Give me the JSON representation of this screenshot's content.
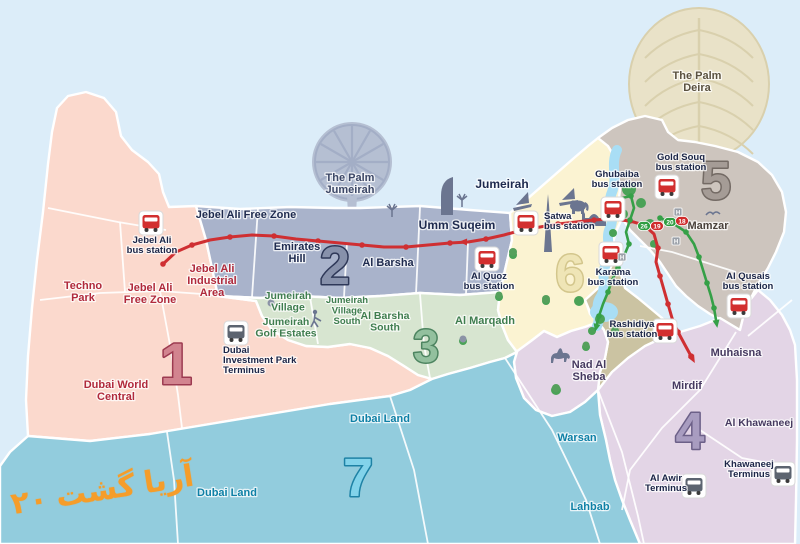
{
  "title": "Dubai bus zones map",
  "colors": {
    "sea": "#dcedf9",
    "creek": "#a9def5",
    "park": "#4aa257",
    "route_red": "#cf2f32",
    "route_green": "#35a047",
    "station_red": "#d22f2f",
    "station_gray": "#5c6470",
    "label_navy": "#1b2547",
    "hmarker": "#9aa0a8"
  },
  "watermark": {
    "part1": "۲۰",
    "part2": "گشت",
    "part3": "آریا"
  },
  "map": {
    "zones": [
      {
        "id": "1",
        "fill": "#fbd9cd",
        "poly": "57,108 68,96 86,92 104,98 116,112 121,136 132,150 148,162 159,174 163,192 169,207 196,206 206,240 212,268 218,296 256,301 262,316 272,330 288,340 306,346 328,347 350,344 370,348 388,356 404,366 418,375 432,379 410,390 390,396 330,404 270,414 210,424 150,434 90,441 28,436 26,400 28,356 32,308 37,260 43,212 48,164 52,132",
        "num": {
          "text": "1",
          "x": 176,
          "y": 384,
          "size": 58,
          "fill": "#d2848f",
          "stroke": "#9c3a50"
        }
      },
      {
        "id": "2",
        "fill": "#a9b3cb",
        "poly": "196,206 240,209 290,207 335,208 360,208 420,206 470,210 510,213 512,240 505,270 500,292 460,295 420,293 380,296 340,298 300,296 260,298 218,296 212,268 206,240",
        "num": {
          "text": "2",
          "x": 335,
          "y": 284,
          "size": 54,
          "fill": "#8791ab",
          "stroke": "#2e3858"
        }
      },
      {
        "id": "3",
        "fill": "#d7e5d0",
        "poly": "218,296 260,298 300,296 340,298 380,296 420,293 460,295 500,292 498,310 502,325 508,340 517,352 505,358 490,362 470,368 448,374 432,379 418,375 404,366 388,356 370,348 350,344 328,347 306,346 288,340 272,330 262,316 256,301",
        "num": {
          "text": "3",
          "x": 426,
          "y": 362,
          "size": 46,
          "fill": "#93c09e",
          "stroke": "#4d8460"
        }
      },
      {
        "id": "6",
        "fill": "#fbf3d2",
        "poly": "510,213 526,200 542,186 558,172 574,158 588,146 598,138 608,146 614,156 618,172 620,190 618,206 622,218 616,232 612,246 616,258 608,272 605,284 596,292 586,302 590,314 598,322 585,327 571,331 557,337 544,331 531,341 517,352 508,340 502,325 498,310 500,292 505,270 512,240",
        "num": {
          "text": "6",
          "x": 570,
          "y": 291,
          "size": 52,
          "fill": "#efe5b6",
          "stroke": "#d3c68c"
        }
      },
      {
        "id": "5",
        "fill": "#cdc5be",
        "poly": "598,138 612,128 628,120 645,116 662,120 668,132 678,140 695,142 715,146 738,152 758,162 772,175 782,192 786,212 784,232 776,252 768,268 758,284 750,300 744,314 740,330 725,322 710,314 698,306 686,296 676,286 668,274 660,262 650,250 640,240 630,230 622,218 618,206 620,190 618,172 614,156 608,146",
        "num": {
          "text": "5",
          "x": 716,
          "y": 199,
          "size": 54,
          "fill": "#a59c96",
          "stroke": "#736a64"
        }
      },
      {
        "id": "khaki",
        "fill": "#cbc3a2",
        "poly": "585,300 596,290 605,282 608,272 616,258 625,288 638,298 650,308 662,318 672,330 680,342 684,355 676,368 662,378 646,386 630,390 614,392 598,390 600,372 605,358 608,342 604,330 598,322 590,312"
      },
      {
        "id": "nad",
        "fill": "#e3d5e6",
        "poly": "516,352 531,341 544,331 557,337 571,331 585,327 598,322 604,330 608,342 605,358 600,372 598,390 585,402 570,412 552,416 536,410 524,398 516,378 514,362"
      },
      {
        "id": "4",
        "fill": "#e3d5e6",
        "poly": "598,390 612,372 628,358 645,346 662,338 680,332 700,326 720,318 740,330 744,314 750,300 758,290 770,300 782,315 790,330 795,345 797,380 797,440 796,500 795,544 640,544 630,520 622,500 615,480 610,460 606,440 600,415",
        "num": {
          "text": "4",
          "x": 690,
          "y": 449,
          "size": 52,
          "fill": "#a89cc0",
          "stroke": "#6c6088"
        }
      },
      {
        "id": "7",
        "fill": "#92ccdd",
        "poly": "28,436 90,441 150,434 210,424 270,414 330,404 390,396 410,390 432,379 448,374 470,368 490,362 505,358 517,352 514,362 516,378 524,398 536,410 552,416 570,412 585,402 598,390 600,415 606,440 610,460 615,480 622,500 630,520 640,544 0,544 0,466 10,452",
        "num": {
          "text": "7",
          "x": 358,
          "y": 496,
          "size": 54,
          "fill": "#82d3ea",
          "stroke": "#1e82a5"
        }
      }
    ],
    "palm_jumeirah": {
      "cx": 352,
      "cy": 162,
      "r": 40,
      "fill": "#b5bfd2",
      "frond": "#a3aec6"
    },
    "palm_deira": {
      "cx": 699,
      "cy": 84,
      "rx": 70,
      "ry": 76,
      "fill": "#e9e2c8",
      "frond": "#d9d0ad"
    },
    "creek": {
      "d": "M 617,150 C 610,165 618,178 612,192 C 606,206 616,216 610,228 C 604,240 614,252 606,264 C 600,276 608,286 600,298 C 594,308 602,316 597,326",
      "blob": {
        "cx": 604,
        "cy": 312,
        "rx": 14,
        "ry": 10
      }
    },
    "parks": [
      [
        629,
        189,
        7
      ],
      [
        641,
        203,
        5
      ],
      [
        623,
        214,
        5
      ],
      [
        650,
        224,
        5
      ],
      [
        613,
        233,
        4
      ],
      [
        654,
        244,
        4
      ],
      [
        600,
        319,
        5
      ],
      [
        592,
        331,
        4
      ],
      [
        579,
        301,
        5
      ],
      [
        586,
        347,
        4
      ],
      [
        615,
        331,
        4
      ],
      [
        513,
        255,
        4
      ],
      [
        556,
        390,
        5
      ],
      [
        463,
        341,
        4
      ],
      [
        546,
        301,
        4
      ],
      [
        499,
        297,
        4
      ]
    ],
    "roads": [
      "48,208 118,222 166,230",
      "40,300 100,293 160,291 216,295",
      "120,222 125,292",
      "160,291 170,345 178,395 182,428",
      "258,208 252,297",
      "347,243 344,297",
      "420,207 416,294",
      "468,242 466,294",
      "310,297 318,344",
      "420,294 424,345 430,378",
      "736,332 700,390 662,428 630,470 622,510",
      "792,300 748,336",
      "700,430 742,458 794,468",
      "598,390 622,452 638,516 644,544",
      "505,358 552,430 586,500 600,544",
      "390,396 414,470 428,544",
      "167,432 174,480 178,544",
      "640,246 672,252 704,262 736,272"
    ],
    "routes": [
      {
        "id": "red-main",
        "color": "#cf2f32",
        "width": 3,
        "dots": true,
        "arrow": false,
        "points": [
          [
            163,
            264
          ],
          [
            176,
            252
          ],
          [
            192,
            245
          ],
          [
            210,
            240
          ],
          [
            230,
            237
          ],
          [
            252,
            235
          ],
          [
            274,
            236
          ],
          [
            296,
            239
          ],
          [
            318,
            241
          ],
          [
            340,
            243
          ],
          [
            362,
            245
          ],
          [
            384,
            247
          ],
          [
            406,
            247
          ],
          [
            428,
            245
          ],
          [
            450,
            243
          ],
          [
            468,
            242
          ],
          [
            486,
            239
          ],
          [
            504,
            235
          ],
          [
            522,
            230
          ],
          [
            540,
            227
          ],
          [
            558,
            224
          ],
          [
            576,
            222
          ],
          [
            594,
            220
          ],
          [
            612,
            219
          ],
          [
            630,
            221
          ],
          [
            644,
            225
          ]
        ]
      },
      {
        "id": "red-south",
        "color": "#cf2f32",
        "width": 3,
        "dots": true,
        "arrow": true,
        "points": [
          [
            644,
            225
          ],
          [
            654,
            234
          ],
          [
            658,
            248
          ],
          [
            656,
            262
          ],
          [
            660,
            276
          ],
          [
            664,
            290
          ],
          [
            668,
            304
          ],
          [
            672,
            318
          ],
          [
            678,
            332
          ],
          [
            685,
            345
          ],
          [
            691,
            356
          ]
        ]
      },
      {
        "id": "green-west",
        "color": "#35a047",
        "width": 2.6,
        "dots": true,
        "arrow": true,
        "points": [
          [
            613,
            205
          ],
          [
            622,
            198
          ],
          [
            631,
            196
          ],
          [
            634,
            208
          ],
          [
            630,
            220
          ],
          [
            626,
            232
          ],
          [
            629,
            244
          ],
          [
            624,
            256
          ],
          [
            618,
            268
          ],
          [
            612,
            280
          ],
          [
            608,
            292
          ],
          [
            603,
            304
          ],
          [
            599,
            316
          ],
          [
            597,
            324
          ]
        ]
      },
      {
        "id": "green-east",
        "color": "#35a047",
        "width": 2.6,
        "dots": true,
        "arrow": true,
        "points": [
          [
            660,
            218
          ],
          [
            674,
            224
          ],
          [
            686,
            232
          ],
          [
            694,
            244
          ],
          [
            699,
            257
          ],
          [
            703,
            270
          ],
          [
            707,
            283
          ],
          [
            711,
            296
          ],
          [
            714,
            308
          ],
          [
            716,
            320
          ]
        ]
      }
    ],
    "route_markers": [
      {
        "x": 467,
        "y": 242,
        "angle": 182,
        "color": "#cf2f32"
      }
    ],
    "badges": [
      {
        "text": "26",
        "fill": "#2f9e41",
        "x": 644,
        "y": 226
      },
      {
        "text": "19",
        "fill": "#cf2b2b",
        "x": 657,
        "y": 226
      },
      {
        "text": "20",
        "fill": "#2f9e41",
        "x": 670,
        "y": 222
      },
      {
        "text": "18",
        "fill": "#cf2b2b",
        "x": 682,
        "y": 221
      }
    ],
    "h_markers": [
      {
        "x": 678,
        "y": 212,
        "text": "H"
      },
      {
        "x": 676,
        "y": 241,
        "text": "H"
      },
      {
        "x": 622,
        "y": 257,
        "text": "H"
      }
    ],
    "stations": [
      {
        "id": "jebel-ali-bus-station",
        "type": "red",
        "x": 151,
        "y": 223,
        "lines": [
          "Jebel Ali",
          "bus station"
        ],
        "lx": 152,
        "ly": 243,
        "anchor": "middle"
      },
      {
        "id": "dubai-investment-park-terminus",
        "type": "gray",
        "x": 236,
        "y": 333,
        "lines": [
          "Dubai",
          "Investment Park",
          "Terminus"
        ],
        "lx": 223,
        "ly": 353,
        "anchor": "start"
      },
      {
        "id": "al-quoz-bus-station",
        "type": "red",
        "x": 487,
        "y": 259,
        "lines": [
          "Al Quoz",
          "bus station"
        ],
        "lx": 489,
        "ly": 279,
        "anchor": "middle"
      },
      {
        "id": "satwa-bus-station",
        "type": "red",
        "x": 526,
        "y": 223,
        "lines": [
          "Satwa",
          "bus station"
        ],
        "lx": 544,
        "ly": 219,
        "anchor": "start"
      },
      {
        "id": "ghubaiba-bus-station",
        "type": "red",
        "x": 613,
        "y": 209,
        "lines": [
          "Ghubaiba",
          "bus station"
        ],
        "lx": 617,
        "ly": 177,
        "anchor": "middle"
      },
      {
        "id": "gold-souq-bus-station",
        "type": "red",
        "x": 667,
        "y": 187,
        "lines": [
          "Gold Souq",
          "bus station"
        ],
        "lx": 681,
        "ly": 160,
        "anchor": "middle"
      },
      {
        "id": "karama-bus-station",
        "type": "red",
        "x": 611,
        "y": 254,
        "lines": [
          "Karama",
          "bus station"
        ],
        "lx": 613,
        "ly": 275,
        "anchor": "middle"
      },
      {
        "id": "rashidiya-bus-station",
        "type": "red",
        "x": 665,
        "y": 331,
        "lines": [
          "Rashidiya",
          "bus station"
        ],
        "lx": 632,
        "ly": 327,
        "anchor": "middle"
      },
      {
        "id": "al-qusais-bus-station",
        "type": "red",
        "x": 739,
        "y": 306,
        "lines": [
          "Al Qusais",
          "bus station"
        ],
        "lx": 748,
        "ly": 279,
        "anchor": "middle"
      },
      {
        "id": "khawaneej-terminus",
        "type": "gray",
        "x": 783,
        "y": 474,
        "lines": [
          "Khawaneej",
          "Terminus"
        ],
        "lx": 749,
        "ly": 467,
        "anchor": "middle"
      },
      {
        "id": "al-awir-terminus",
        "type": "gray",
        "x": 694,
        "y": 486,
        "lines": [
          "Al Awir",
          "Terminus"
        ],
        "lx": 666,
        "ly": 481,
        "anchor": "middle"
      }
    ],
    "labels": [
      {
        "text": "Techno\nPark",
        "x": 83,
        "y": 289,
        "size": 11,
        "color": "#b02a3c"
      },
      {
        "text": "Jebel Ali\nFree Zone",
        "x": 150,
        "y": 291,
        "size": 11,
        "color": "#b02a3c"
      },
      {
        "text": "Jebel Ali\nIndustrial\nArea",
        "x": 212,
        "y": 272,
        "size": 11,
        "color": "#b02a3c"
      },
      {
        "text": "Dubai World\nCentral",
        "x": 116,
        "y": 388,
        "size": 11,
        "color": "#b02a3c"
      },
      {
        "text": "Jebel Ali Free Zone",
        "x": 246,
        "y": 218,
        "size": 11,
        "color": "#1e2a4e"
      },
      {
        "text": "Emirates\nHill",
        "x": 297,
        "y": 250,
        "size": 11,
        "color": "#1e2a4e"
      },
      {
        "text": "Al Barsha",
        "x": 388,
        "y": 266,
        "size": 11,
        "color": "#1e2a4e"
      },
      {
        "text": "Umm Suqeim",
        "x": 457,
        "y": 229,
        "size": 12,
        "color": "#1e2a4e"
      },
      {
        "text": "The Palm\nJumeirah",
        "x": 350,
        "y": 181,
        "size": 11,
        "color": "#3c4766"
      },
      {
        "text": "Jumeirah",
        "x": 502,
        "y": 188,
        "size": 12,
        "color": "#1e2a4e"
      },
      {
        "text": "Jumeirah\nVillage",
        "x": 288,
        "y": 299,
        "size": 10.5,
        "color": "#3f7d4f"
      },
      {
        "text": "Jumeirah\nVillage\nSouth",
        "x": 347,
        "y": 303,
        "size": 9.5,
        "color": "#3f7d4f"
      },
      {
        "text": "Al Barsha\nSouth",
        "x": 385,
        "y": 319,
        "size": 10.5,
        "color": "#3f7d4f"
      },
      {
        "text": "Jumeirah\nGolf Estates",
        "x": 286,
        "y": 325,
        "size": 10.5,
        "color": "#3f7d4f"
      },
      {
        "text": "Al Marqadh",
        "x": 485,
        "y": 324,
        "size": 11,
        "color": "#3f7d4f"
      },
      {
        "text": "The Palm\nDeira",
        "x": 697,
        "y": 79,
        "size": 11,
        "color": "#5a5140"
      },
      {
        "text": "Mamzar",
        "x": 708,
        "y": 229,
        "size": 11,
        "color": "#4a423c"
      },
      {
        "text": "Muhaisna",
        "x": 736,
        "y": 356,
        "size": 11,
        "color": "#463a60"
      },
      {
        "text": "Mirdif",
        "x": 687,
        "y": 389,
        "size": 11,
        "color": "#463a60"
      },
      {
        "text": "Al Khawaneej",
        "x": 759,
        "y": 426,
        "size": 10.5,
        "color": "#463a60"
      },
      {
        "text": "Nad Al\nSheba",
        "x": 589,
        "y": 368,
        "size": 11,
        "color": "#463a60"
      },
      {
        "text": "Dubai Land",
        "x": 380,
        "y": 422,
        "size": 11,
        "color": "#0e80a6"
      },
      {
        "text": "Dubai Land",
        "x": 227,
        "y": 496,
        "size": 11,
        "color": "#0e80a6"
      },
      {
        "text": "Warsan",
        "x": 577,
        "y": 441,
        "size": 11,
        "color": "#0e80a6"
      },
      {
        "text": "Lahbab",
        "x": 590,
        "y": 510,
        "size": 11,
        "color": "#0e80a6"
      }
    ]
  }
}
